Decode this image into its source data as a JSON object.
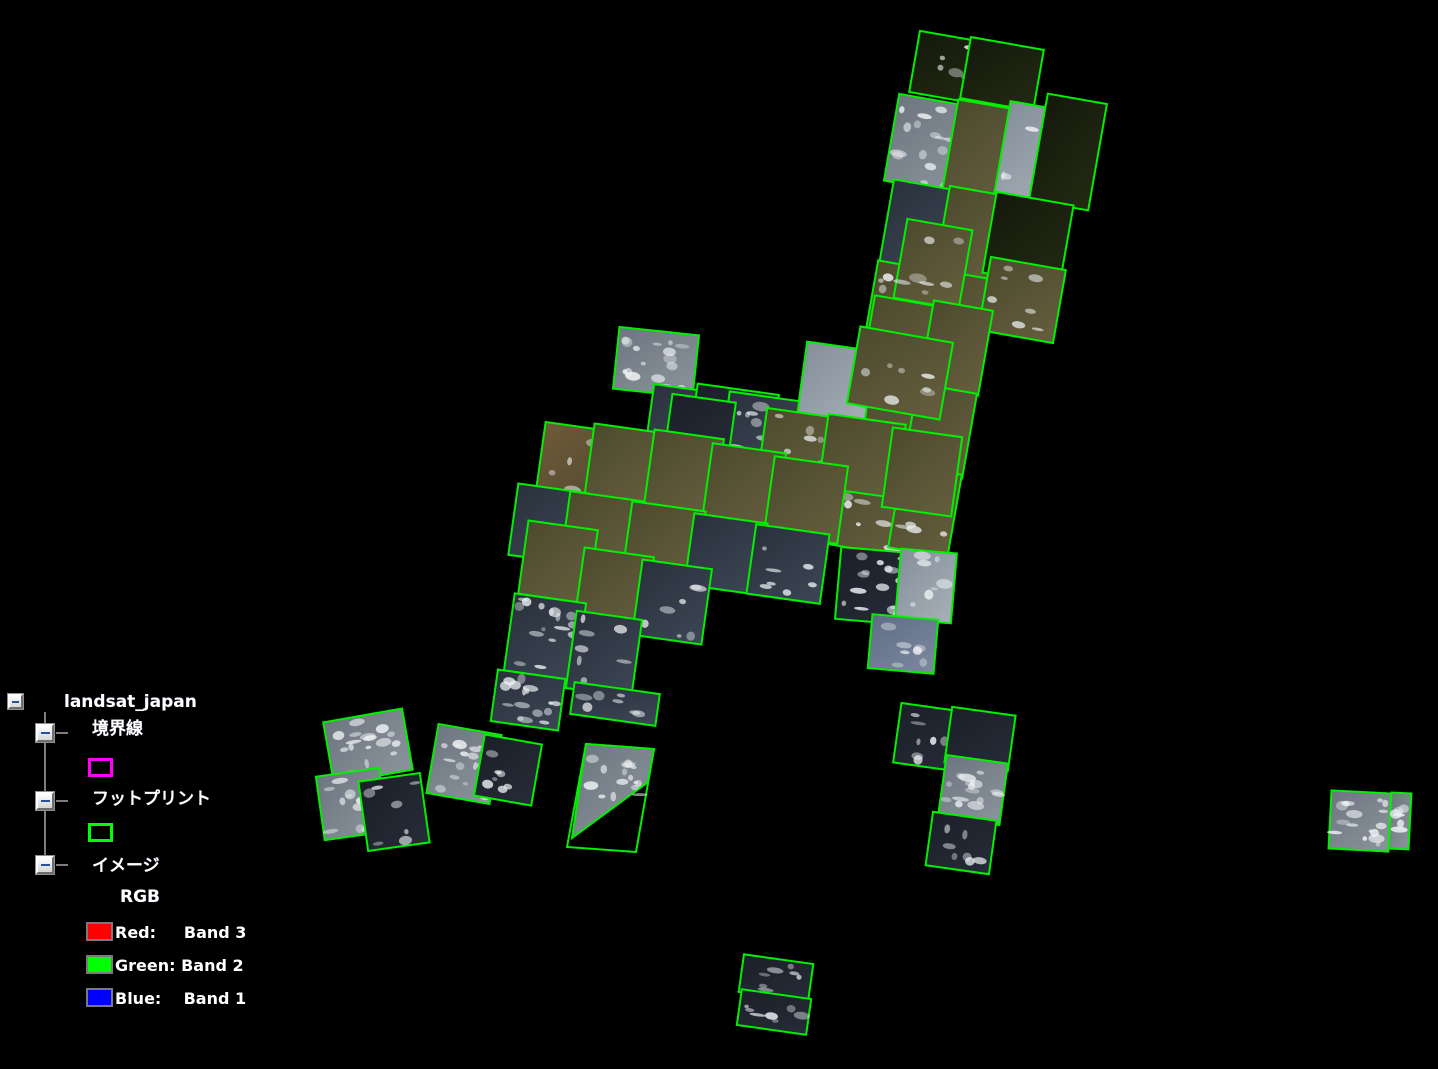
{
  "window": {
    "background": "#000000"
  },
  "legend": {
    "root_label": "landsat_japan",
    "items": [
      {
        "label": "境界線",
        "swatch": {
          "type": "outline",
          "color": "#ff00ff"
        }
      },
      {
        "label": "フットプリント",
        "swatch": {
          "type": "outline",
          "color": "#00ff00"
        }
      },
      {
        "label": "イメージ",
        "sub_label": "RGB",
        "bands": [
          {
            "label": "Red:     Band 3",
            "color": "#ff0000"
          },
          {
            "label": "Green: Band 2",
            "color": "#00ff00"
          },
          {
            "label": "Blue:    Band 1",
            "color": "#0000ff"
          }
        ]
      }
    ]
  },
  "map": {
    "stroke": "#00f000",
    "stroke_width": 2,
    "fills": {
      "ld": [
        "#14180c",
        "#232a12"
      ],
      "lo": [
        "#4c4a2e",
        "#655e3d"
      ],
      "lb": [
        "#6e5a38",
        "#4f4830"
      ],
      "oc": [
        "#2a313d",
        "#3c4654"
      ],
      "od": [
        "#1b1f28",
        "#262c38"
      ],
      "oh": [
        "#848f9a",
        "#a7b0b8"
      ],
      "ob": [
        "#5f6d85",
        "#7c89a0"
      ],
      "cl": [
        "#6d7680",
        "#8b949c"
      ]
    },
    "footprints": [
      [
        952,
        68,
        76,
        62,
        10,
        "ld",
        1
      ],
      [
        1002,
        74,
        74,
        62,
        10,
        "ld",
        0
      ],
      [
        930,
        144,
        78,
        88,
        10,
        "cl",
        2
      ],
      [
        986,
        150,
        72,
        90,
        10,
        "lo",
        0
      ],
      [
        1040,
        153,
        76,
        92,
        10,
        "oh",
        1
      ],
      [
        1068,
        152,
        60,
        108,
        10,
        "ld",
        0
      ],
      [
        922,
        228,
        72,
        86,
        10,
        "oc",
        0
      ],
      [
        975,
        234,
        66,
        86,
        10,
        "lo",
        0
      ],
      [
        1028,
        239,
        78,
        82,
        10,
        "ld",
        0
      ],
      [
        906,
        310,
        72,
        88,
        10,
        "lo",
        2
      ],
      [
        958,
        316,
        62,
        84,
        10,
        "lo",
        0
      ],
      [
        1022,
        300,
        76,
        74,
        10,
        "lo",
        1
      ],
      [
        933,
        264,
        66,
        80,
        10,
        "lo",
        1
      ],
      [
        903,
        344,
        72,
        86,
        10,
        "lo",
        0
      ],
      [
        956,
        348,
        60,
        86,
        10,
        "lo",
        0
      ],
      [
        888,
        427,
        72,
        86,
        10,
        "lo",
        0
      ],
      [
        940,
        431,
        60,
        86,
        10,
        "lo",
        0
      ],
      [
        872,
        508,
        70,
        86,
        10,
        "lo",
        1
      ],
      [
        925,
        511,
        60,
        84,
        10,
        "lo",
        1
      ],
      [
        656,
        362,
        80,
        62,
        6,
        "cl",
        2
      ],
      [
        680,
        416,
        60,
        56,
        8,
        "oc",
        0
      ],
      [
        734,
        420,
        82,
        62,
        8,
        "od",
        1
      ],
      [
        835,
        388,
        68,
        84,
        8,
        "oh",
        0
      ],
      [
        900,
        373,
        94,
        78,
        10,
        "lo",
        1
      ],
      [
        760,
        428,
        70,
        64,
        8,
        "oc",
        1
      ],
      [
        700,
        428,
        64,
        60,
        8,
        "od",
        0
      ],
      [
        800,
        448,
        76,
        70,
        8,
        "lo",
        1
      ],
      [
        862,
        456,
        78,
        74,
        8,
        "lo",
        0
      ],
      [
        922,
        472,
        70,
        80,
        8,
        "lo",
        0
      ],
      [
        578,
        472,
        78,
        90,
        8,
        "lb",
        1
      ],
      [
        624,
        466,
        70,
        76,
        8,
        "lo",
        0
      ],
      [
        684,
        472,
        70,
        76,
        8,
        "lo",
        0
      ],
      [
        744,
        487,
        74,
        78,
        8,
        "lo",
        0
      ],
      [
        806,
        500,
        74,
        78,
        8,
        "lo",
        0
      ],
      [
        548,
        524,
        70,
        72,
        8,
        "oc",
        0
      ],
      [
        602,
        532,
        74,
        72,
        8,
        "lo",
        0
      ],
      [
        664,
        542,
        74,
        72,
        8,
        "lo",
        0
      ],
      [
        726,
        554,
        74,
        72,
        8,
        "oc",
        0
      ],
      [
        788,
        564,
        74,
        70,
        8,
        "oc",
        1
      ],
      [
        558,
        562,
        70,
        74,
        8,
        "lo",
        0
      ],
      [
        614,
        590,
        70,
        76,
        8,
        "lo",
        0
      ],
      [
        672,
        602,
        70,
        76,
        8,
        "oc",
        1
      ],
      [
        545,
        637,
        72,
        78,
        8,
        "oc",
        2
      ],
      [
        604,
        654,
        66,
        78,
        8,
        "oc",
        1
      ],
      [
        528,
        700,
        68,
        52,
        8,
        "oc",
        2
      ],
      [
        615,
        704,
        86,
        32,
        8,
        "oc",
        1
      ],
      [
        874,
        586,
        72,
        72,
        5,
        "od",
        2
      ],
      [
        926,
        586,
        56,
        70,
        5,
        "oh",
        1
      ],
      [
        903,
        644,
        66,
        54,
        5,
        "ob",
        1
      ],
      [
        368,
        746,
        80,
        62,
        -10,
        "cl",
        2
      ],
      [
        352,
        804,
        64,
        64,
        -8,
        "cl",
        2
      ],
      [
        394,
        812,
        62,
        70,
        -8,
        "od",
        1
      ],
      [
        464,
        764,
        64,
        70,
        10,
        "cl",
        2
      ],
      [
        508,
        770,
        58,
        62,
        10,
        "od",
        1
      ],
      [
        928,
        737,
        62,
        60,
        8,
        "od",
        1
      ],
      [
        980,
        739,
        64,
        56,
        8,
        "od",
        0
      ],
      [
        973,
        790,
        62,
        62,
        8,
        "cl",
        2
      ],
      [
        961,
        843,
        64,
        54,
        8,
        "od",
        1
      ],
      [
        1360,
        821,
        60,
        58,
        3,
        "cl",
        2
      ],
      [
        1400,
        821,
        20,
        56,
        3,
        "cl",
        1
      ],
      [
        776,
        978,
        70,
        38,
        8,
        "od",
        1
      ],
      [
        774,
        1012,
        70,
        36,
        8,
        "od",
        1
      ]
    ],
    "polygons": [
      {
        "pts": [
          [
            586,
            744
          ],
          [
            654,
            749
          ],
          [
            636,
            852
          ],
          [
            567,
            847
          ]
        ],
        "fill": "none",
        "clouds": 0
      },
      {
        "pts": [
          [
            586,
            744
          ],
          [
            654,
            749
          ],
          [
            648,
            782
          ],
          [
            572,
            838
          ]
        ],
        "fill": "cl",
        "clouds": 2
      }
    ]
  }
}
